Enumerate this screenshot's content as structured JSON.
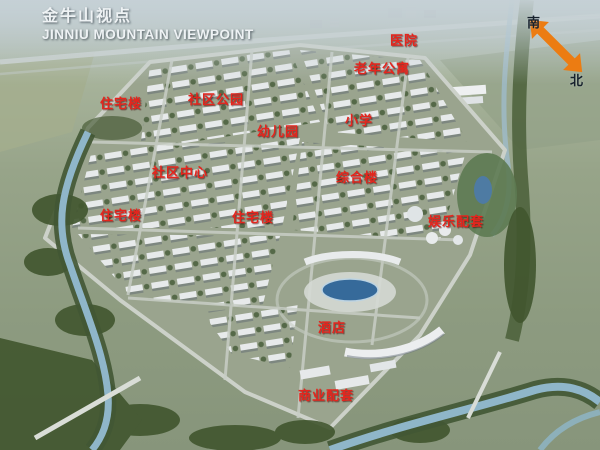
{
  "title": {
    "line1": "金牛山视点",
    "line2": "JINNIU MOUNTAIN VIEWPOINT"
  },
  "compass": {
    "south_label": "南",
    "north_label": "北"
  },
  "map_labels": [
    {
      "id": "hospital",
      "text": "医院"
    },
    {
      "id": "elderly-apartments",
      "text": "老年公寓"
    },
    {
      "id": "residential-northwest",
      "text": "住宅楼"
    },
    {
      "id": "community-park",
      "text": "社区公园"
    },
    {
      "id": "kindergarten",
      "text": "幼儿园"
    },
    {
      "id": "primary-school",
      "text": "小学"
    },
    {
      "id": "community-center",
      "text": "社区中心"
    },
    {
      "id": "complex-building",
      "text": "综合楼"
    },
    {
      "id": "residential-west",
      "text": "住宅楼"
    },
    {
      "id": "residential-central",
      "text": "住宅楼"
    },
    {
      "id": "entertainment-facilities",
      "text": "娱乐配套"
    },
    {
      "id": "hotel",
      "text": "酒店"
    },
    {
      "id": "commercial-facilities",
      "text": "商业配套"
    }
  ],
  "colors": {
    "label_red": "#e5251d",
    "arrow_orange": "#ec7c12",
    "title_white": "#eef2f4",
    "water_blue": "#8fb6c9",
    "lake_blue": "#366a9a",
    "building_white": "#e7eaeb",
    "tree_green": "#42572f"
  }
}
